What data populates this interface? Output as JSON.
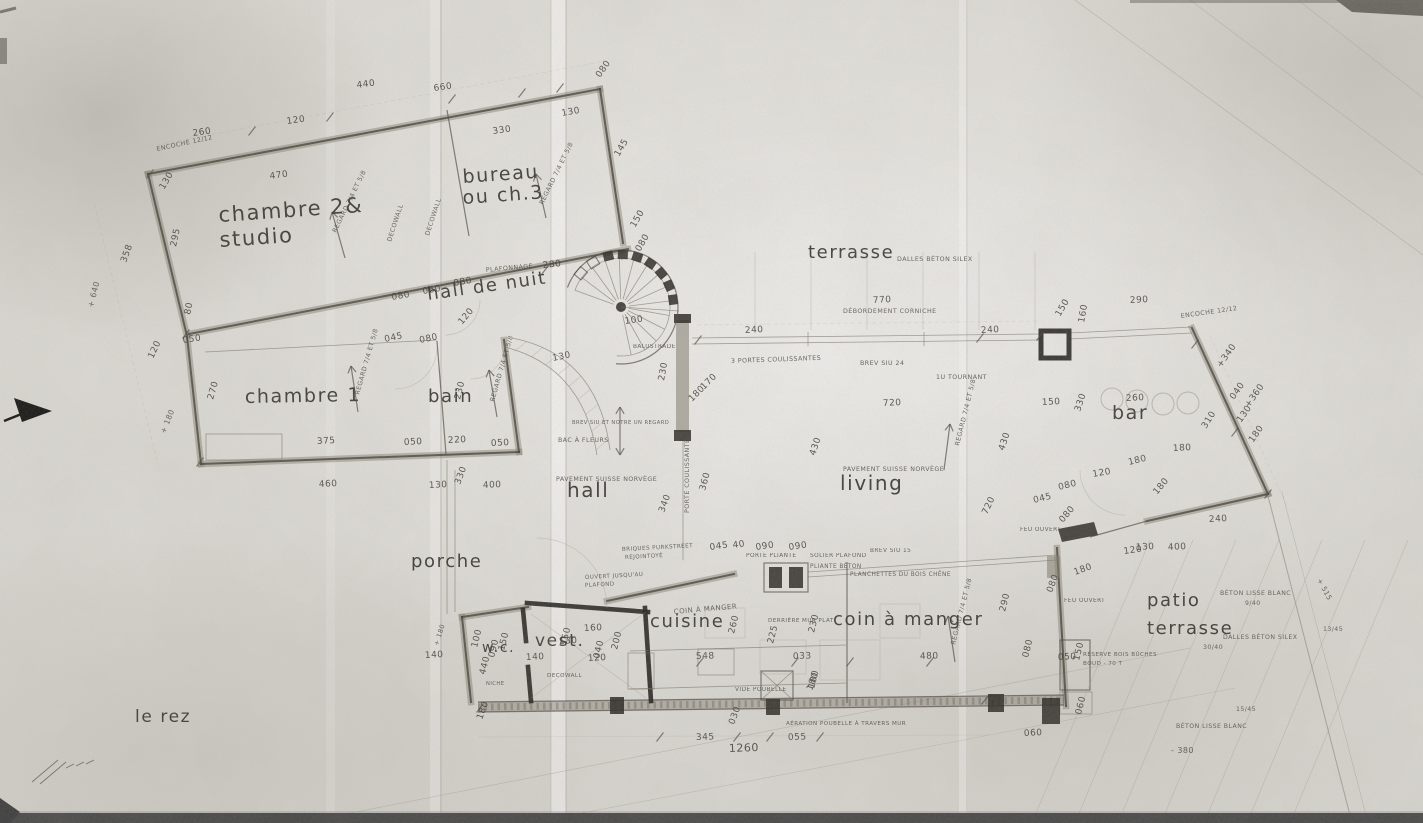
{
  "title": "le rez",
  "colors": {
    "paper": "#dedcd6",
    "ink": "#3a3732",
    "wall_gray": "#7d7768",
    "wall_dark": "#211f1b"
  },
  "rooms": [
    {
      "t": "chambre 2&",
      "x": 219,
      "y": 222,
      "s": 21,
      "r": -4
    },
    {
      "t": "studio",
      "x": 220,
      "y": 247,
      "s": 21,
      "r": -4
    },
    {
      "t": "bureau",
      "x": 463,
      "y": 183,
      "s": 19,
      "r": -4
    },
    {
      "t": "ou ch.3",
      "x": 463,
      "y": 204,
      "s": 19,
      "r": -4
    },
    {
      "t": "hall de nuit",
      "x": 428,
      "y": 300,
      "s": 18,
      "r": -8
    },
    {
      "t": "chambre 1",
      "x": 245,
      "y": 403,
      "s": 19,
      "r": -1
    },
    {
      "t": "bain",
      "x": 428,
      "y": 402,
      "s": 18,
      "r": 0
    },
    {
      "t": "hall",
      "x": 567,
      "y": 497,
      "s": 20,
      "r": 0
    },
    {
      "t": "porche",
      "x": 411,
      "y": 567,
      "s": 18,
      "r": 0
    },
    {
      "t": "terrasse",
      "x": 808,
      "y": 258,
      "s": 18,
      "r": 0,
      "ls": 5
    },
    {
      "t": "bar",
      "x": 1112,
      "y": 419,
      "s": 19,
      "r": 0
    },
    {
      "t": "living",
      "x": 840,
      "y": 490,
      "s": 20,
      "r": 0,
      "ls": 2
    },
    {
      "t": "cuisine",
      "x": 650,
      "y": 627,
      "s": 18,
      "r": 0
    },
    {
      "t": "coin à manger",
      "x": 833,
      "y": 625,
      "s": 18,
      "r": 0
    },
    {
      "t": "w.c.",
      "x": 482,
      "y": 652,
      "s": 14,
      "r": 0
    },
    {
      "t": "vest.",
      "x": 535,
      "y": 646,
      "s": 17,
      "r": 0
    },
    {
      "t": "patio",
      "x": 1147,
      "y": 606,
      "s": 18,
      "r": 0,
      "ls": 2
    },
    {
      "t": "terrasse",
      "x": 1147,
      "y": 634,
      "s": 18,
      "r": 0,
      "ls": 2
    },
    {
      "t": "le rez",
      "x": 135,
      "y": 722,
      "s": 17,
      "r": 0,
      "ls": 4
    }
  ],
  "dims": [
    {
      "t": "260",
      "x": 193,
      "y": 136,
      "r": -8
    },
    {
      "t": "120",
      "x": 287,
      "y": 124,
      "r": -8
    },
    {
      "t": "440",
      "x": 357,
      "y": 88,
      "r": -8
    },
    {
      "t": "660",
      "x": 434,
      "y": 91,
      "r": -8
    },
    {
      "t": "470",
      "x": 270,
      "y": 179,
      "r": -8
    },
    {
      "t": "330",
      "x": 493,
      "y": 134,
      "r": -8
    },
    {
      "t": "130",
      "x": 562,
      "y": 116,
      "r": -10
    },
    {
      "t": "080",
      "x": 600,
      "y": 78,
      "r": -55
    },
    {
      "t": "145",
      "x": 619,
      "y": 157,
      "r": -60
    },
    {
      "t": "150",
      "x": 635,
      "y": 228,
      "r": -60
    },
    {
      "t": "080",
      "x": 640,
      "y": 252,
      "r": -60
    },
    {
      "t": "295",
      "x": 176,
      "y": 247,
      "r": -78
    },
    {
      "t": "80",
      "x": 190,
      "y": 315,
      "r": -78
    },
    {
      "t": "050",
      "x": 183,
      "y": 343,
      "r": -8
    },
    {
      "t": "358",
      "x": 126,
      "y": 263,
      "r": -70
    },
    {
      "t": "130",
      "x": 164,
      "y": 190,
      "r": -60
    },
    {
      "t": "120",
      "x": 153,
      "y": 359,
      "r": -65
    },
    {
      "t": "270",
      "x": 213,
      "y": 400,
      "r": -74
    },
    {
      "t": "375",
      "x": 317,
      "y": 444,
      "r": -3
    },
    {
      "t": "050",
      "x": 404,
      "y": 445,
      "r": -3
    },
    {
      "t": "220",
      "x": 448,
      "y": 443,
      "r": -3
    },
    {
      "t": "050",
      "x": 491,
      "y": 446,
      "r": -3
    },
    {
      "t": "460",
      "x": 319,
      "y": 487,
      "r": -3
    },
    {
      "t": "130",
      "x": 429,
      "y": 488,
      "r": -3
    },
    {
      "t": "330",
      "x": 460,
      "y": 485,
      "r": -70
    },
    {
      "t": "400",
      "x": 483,
      "y": 488,
      "r": -3
    },
    {
      "t": "230",
      "x": 460,
      "y": 400,
      "r": -76
    },
    {
      "t": "045",
      "x": 385,
      "y": 342,
      "r": -12
    },
    {
      "t": "080",
      "x": 420,
      "y": 343,
      "r": -12
    },
    {
      "t": "080",
      "x": 392,
      "y": 300,
      "r": -10
    },
    {
      "t": "060",
      "x": 423,
      "y": 294,
      "r": -10
    },
    {
      "t": "080",
      "x": 454,
      "y": 286,
      "r": -10
    },
    {
      "t": "280",
      "x": 543,
      "y": 268,
      "r": -6
    },
    {
      "t": "130",
      "x": 553,
      "y": 361,
      "r": -12
    },
    {
      "t": "100",
      "x": 625,
      "y": 324,
      "r": -8
    },
    {
      "t": "120",
      "x": 462,
      "y": 325,
      "r": -50
    },
    {
      "t": "240",
      "x": 745,
      "y": 333,
      "r": -3
    },
    {
      "t": "240",
      "x": 981,
      "y": 333,
      "r": -3
    },
    {
      "t": "770",
      "x": 873,
      "y": 303,
      "r": -3
    },
    {
      "t": "290",
      "x": 1130,
      "y": 303,
      "r": -3
    },
    {
      "t": "150",
      "x": 1060,
      "y": 317,
      "r": -60
    },
    {
      "t": "160",
      "x": 1084,
      "y": 323,
      "r": -80
    },
    {
      "t": "230",
      "x": 664,
      "y": 381,
      "r": -80
    },
    {
      "t": "170",
      "x": 704,
      "y": 390,
      "r": -45
    },
    {
      "t": "180",
      "x": 692,
      "y": 402,
      "r": -45
    },
    {
      "t": "720",
      "x": 883,
      "y": 406,
      "r": -3
    },
    {
      "t": "430",
      "x": 815,
      "y": 456,
      "r": -72
    },
    {
      "t": "430",
      "x": 1004,
      "y": 451,
      "r": -72
    },
    {
      "t": "720",
      "x": 987,
      "y": 515,
      "r": -65
    },
    {
      "t": "360",
      "x": 705,
      "y": 491,
      "r": -75
    },
    {
      "t": "340",
      "x": 664,
      "y": 513,
      "r": -70
    },
    {
      "t": "260",
      "x": 1126,
      "y": 401,
      "r": -3
    },
    {
      "t": "150",
      "x": 1042,
      "y": 405,
      "r": -3
    },
    {
      "t": "330",
      "x": 1080,
      "y": 412,
      "r": -72
    },
    {
      "t": "180",
      "x": 1173,
      "y": 451,
      "r": -3
    },
    {
      "t": "310",
      "x": 1206,
      "y": 429,
      "r": -58
    },
    {
      "t": "130",
      "x": 1241,
      "y": 423,
      "r": -55
    },
    {
      "t": "040",
      "x": 1234,
      "y": 400,
      "r": -55
    },
    {
      "t": "+340",
      "x": 1221,
      "y": 368,
      "r": -55
    },
    {
      "t": "+360",
      "x": 1249,
      "y": 408,
      "r": -55
    },
    {
      "t": "180",
      "x": 1253,
      "y": 443,
      "r": -55
    },
    {
      "t": "240",
      "x": 1209,
      "y": 522,
      "r": -3
    },
    {
      "t": "400",
      "x": 1168,
      "y": 550,
      "r": -3
    },
    {
      "t": "130",
      "x": 1136,
      "y": 550,
      "r": -3
    },
    {
      "t": "180",
      "x": 1129,
      "y": 465,
      "r": -14
    },
    {
      "t": "120",
      "x": 1093,
      "y": 477,
      "r": -10
    },
    {
      "t": "080",
      "x": 1059,
      "y": 490,
      "r": -14
    },
    {
      "t": "045",
      "x": 1034,
      "y": 503,
      "r": -14
    },
    {
      "t": "080",
      "x": 1063,
      "y": 523,
      "r": -50
    },
    {
      "t": "180",
      "x": 1157,
      "y": 495,
      "r": -50
    },
    {
      "t": "120",
      "x": 1124,
      "y": 554,
      "r": -8
    },
    {
      "t": "180",
      "x": 1075,
      "y": 575,
      "r": -20
    },
    {
      "t": "080",
      "x": 1052,
      "y": 593,
      "r": -70
    },
    {
      "t": "050",
      "x": 1058,
      "y": 660,
      "r": -3
    },
    {
      "t": "150",
      "x": 1079,
      "y": 661,
      "r": -76
    },
    {
      "t": "080",
      "x": 1028,
      "y": 658,
      "r": -76
    },
    {
      "t": "060",
      "x": 1081,
      "y": 715,
      "r": -76
    },
    {
      "t": "060",
      "x": 1024,
      "y": 736,
      "r": -3
    },
    {
      "t": "345",
      "x": 696,
      "y": 740,
      "r": -2
    },
    {
      "t": "1260",
      "x": 729,
      "y": 752,
      "r": -2,
      "s": 11
    },
    {
      "t": "055",
      "x": 788,
      "y": 740,
      "r": -2
    },
    {
      "t": "180",
      "x": 812,
      "y": 691,
      "r": -70
    },
    {
      "t": "030",
      "x": 734,
      "y": 725,
      "r": -70
    },
    {
      "t": "180",
      "x": 482,
      "y": 720,
      "r": -70
    },
    {
      "t": "140",
      "x": 425,
      "y": 658,
      "r": -3
    },
    {
      "t": "100",
      "x": 477,
      "y": 648,
      "r": -76
    },
    {
      "t": "090",
      "x": 494,
      "y": 658,
      "r": -76
    },
    {
      "t": "440",
      "x": 485,
      "y": 675,
      "r": -76
    },
    {
      "t": "150",
      "x": 504,
      "y": 651,
      "r": -76
    },
    {
      "t": "130",
      "x": 559,
      "y": 644,
      "r": -3
    },
    {
      "t": "140",
      "x": 526,
      "y": 660,
      "r": -3
    },
    {
      "t": "150",
      "x": 566,
      "y": 646,
      "r": -76
    },
    {
      "t": "120",
      "x": 588,
      "y": 661,
      "r": -3
    },
    {
      "t": "160",
      "x": 584,
      "y": 631,
      "r": -3
    },
    {
      "t": "200",
      "x": 617,
      "y": 650,
      "r": -76
    },
    {
      "t": "040",
      "x": 599,
      "y": 659,
      "r": -76
    },
    {
      "t": "260",
      "x": 734,
      "y": 634,
      "r": -76
    },
    {
      "t": "225",
      "x": 773,
      "y": 644,
      "r": -76
    },
    {
      "t": "230",
      "x": 814,
      "y": 633,
      "r": -76
    },
    {
      "t": "180",
      "x": 814,
      "y": 689,
      "r": -76
    },
    {
      "t": "548",
      "x": 696,
      "y": 659,
      "r": -2
    },
    {
      "t": "033",
      "x": 793,
      "y": 659,
      "r": -2
    },
    {
      "t": "480",
      "x": 920,
      "y": 659,
      "r": -2
    },
    {
      "t": "290",
      "x": 1005,
      "y": 612,
      "r": -76
    },
    {
      "t": "045",
      "x": 710,
      "y": 550,
      "r": -8
    },
    {
      "t": "40",
      "x": 733,
      "y": 548,
      "r": -8
    },
    {
      "t": "090",
      "x": 756,
      "y": 550,
      "r": -8
    },
    {
      "t": "090",
      "x": 789,
      "y": 550,
      "r": -8
    }
  ],
  "notes": [
    {
      "t": "encoche 12/12",
      "x": 157,
      "y": 151,
      "r": -12
    },
    {
      "t": "regard 7/4 et 5/8",
      "x": 336,
      "y": 233,
      "r": -64
    },
    {
      "t": "regard 7/4 et 5/8",
      "x": 543,
      "y": 205,
      "r": -64
    },
    {
      "t": "decowall",
      "x": 391,
      "y": 242,
      "r": -72
    },
    {
      "t": "decowall",
      "x": 429,
      "y": 236,
      "r": -72
    },
    {
      "t": "regard 7/4 et 5/8",
      "x": 359,
      "y": 395,
      "r": -74
    },
    {
      "t": "regard 7/4 et 5/8",
      "x": 494,
      "y": 402,
      "r": -74
    },
    {
      "t": "regard 7/4 et 5/8",
      "x": 959,
      "y": 446,
      "r": -76
    },
    {
      "t": "regard 7/4 et 5/8",
      "x": 955,
      "y": 645,
      "r": -76
    },
    {
      "t": "plafonnage",
      "x": 486,
      "y": 272,
      "r": -5
    },
    {
      "t": "balustrade",
      "x": 633,
      "y": 348,
      "r": 0,
      "s": 5.8
    },
    {
      "t": "3 portes coulissantes",
      "x": 731,
      "y": 363,
      "r": -2
    },
    {
      "t": "brev siu 24",
      "x": 860,
      "y": 365,
      "r": 0
    },
    {
      "t": "débordement corniche",
      "x": 843,
      "y": 313,
      "r": 0
    },
    {
      "t": "1u tournant",
      "x": 936,
      "y": 379,
      "r": 0
    },
    {
      "t": "dalles béton silex",
      "x": 897,
      "y": 261,
      "r": 0
    },
    {
      "t": "encoche 12/12",
      "x": 1181,
      "y": 318,
      "r": -8
    },
    {
      "t": "bac à fleurs",
      "x": 558,
      "y": 442,
      "r": 0
    },
    {
      "t": "brev siu et notre un regard",
      "x": 572,
      "y": 424,
      "r": 0,
      "s": 5.2
    },
    {
      "t": "pavement suisse norvège",
      "x": 556,
      "y": 481,
      "r": 0
    },
    {
      "t": "pavement suisse norvège",
      "x": 843,
      "y": 471,
      "r": 0
    },
    {
      "t": "porte coulissante",
      "x": 689,
      "y": 513,
      "r": -90
    },
    {
      "t": "briques purkstreet",
      "x": 622,
      "y": 551,
      "r": -3,
      "s": 5.6
    },
    {
      "t": "rejointoyé",
      "x": 625,
      "y": 559,
      "r": -3,
      "s": 5.6
    },
    {
      "t": "ouvert jusqu'au",
      "x": 585,
      "y": 579,
      "r": -3,
      "s": 5.6
    },
    {
      "t": "plafond",
      "x": 585,
      "y": 587,
      "r": -3,
      "s": 5.6
    },
    {
      "t": "porte pliante",
      "x": 746,
      "y": 557,
      "r": 0,
      "s": 5.8
    },
    {
      "t": "solier plafond",
      "x": 810,
      "y": 557,
      "r": 0,
      "s": 5.8
    },
    {
      "t": "pliante béton",
      "x": 810,
      "y": 568,
      "r": 0,
      "s": 5.8
    },
    {
      "t": "brev siu 15",
      "x": 870,
      "y": 552,
      "r": 0,
      "s": 5.8
    },
    {
      "t": "planchettes du bois chêne",
      "x": 850,
      "y": 576,
      "r": 0,
      "s": 5.8
    },
    {
      "t": "coin à manger",
      "x": 674,
      "y": 614,
      "r": -5,
      "s": 7
    },
    {
      "t": "derrière mur plat",
      "x": 768,
      "y": 622,
      "r": 0,
      "s": 5.6
    },
    {
      "t": "vide poubelle",
      "x": 735,
      "y": 691,
      "r": 0,
      "s": 5.8
    },
    {
      "t": "aération poubelle à travers mur",
      "x": 786,
      "y": 725,
      "r": 0,
      "s": 5.6
    },
    {
      "t": "decowall",
      "x": 547,
      "y": 677,
      "r": 0,
      "s": 5.6
    },
    {
      "t": "niche",
      "x": 486,
      "y": 685,
      "r": 0,
      "s": 5.2
    },
    {
      "t": "feu ouvert",
      "x": 1020,
      "y": 531,
      "r": 0,
      "s": 5.8
    },
    {
      "t": "feu ouvert",
      "x": 1064,
      "y": 602,
      "r": 0,
      "s": 5.8
    },
    {
      "t": "réserve bois bûches",
      "x": 1083,
      "y": 656,
      "r": 0,
      "s": 5.6
    },
    {
      "t": "boud - 70 t",
      "x": 1083,
      "y": 665,
      "r": 0,
      "s": 5.6
    },
    {
      "t": "béton lisse blanc",
      "x": 1220,
      "y": 595,
      "r": 0,
      "s": 6.2
    },
    {
      "t": "9/40",
      "x": 1245,
      "y": 605,
      "r": 0,
      "s": 6.2
    },
    {
      "t": "dalles béton silex",
      "x": 1223,
      "y": 639,
      "r": 0,
      "s": 6.2
    },
    {
      "t": "30/40",
      "x": 1203,
      "y": 649,
      "r": 0,
      "s": 6.2
    },
    {
      "t": "13/45",
      "x": 1323,
      "y": 631,
      "r": 0,
      "s": 6.2
    },
    {
      "t": "15/45",
      "x": 1236,
      "y": 711,
      "r": 0,
      "s": 6.2
    },
    {
      "t": "béton lisse blanc",
      "x": 1176,
      "y": 728,
      "r": 0,
      "s": 6.2
    },
    {
      "t": "- 380",
      "x": 1171,
      "y": 753,
      "r": 0,
      "s": 8
    },
    {
      "t": "+ 515",
      "x": 1317,
      "y": 580,
      "r": 62,
      "s": 7
    },
    {
      "t": "+ 640",
      "x": 93,
      "y": 308,
      "r": -76,
      "s": 8
    },
    {
      "t": "+ 180",
      "x": 165,
      "y": 434,
      "r": -68,
      "s": 7.5
    },
    {
      "t": "+ 180",
      "x": 438,
      "y": 646,
      "r": -72,
      "s": 6.5
    }
  ]
}
